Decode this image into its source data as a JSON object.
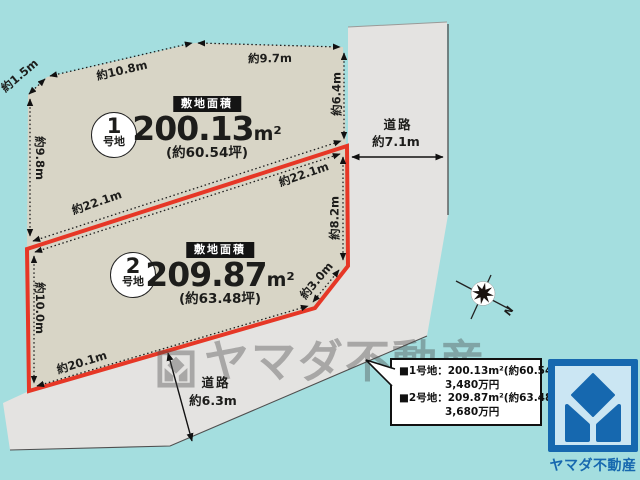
{
  "colors": {
    "background_teal": "#a4dedf",
    "plot_fill": "#d8d5c6",
    "road_fill": "#e4e3e1",
    "boundary_red": "#e63726",
    "brand_blue": "#1668af"
  },
  "plots": [
    {
      "circle_number": "1",
      "circle_suffix": "号地",
      "badge": "敷地面積",
      "area_value": "200.13",
      "area_unit": "m²",
      "tsubo": "(約60.54坪)"
    },
    {
      "circle_number": "2",
      "circle_suffix": "号地",
      "badge": "敷地面積",
      "area_value": "209.87",
      "area_unit": "m²",
      "tsubo": "(約63.48坪)"
    }
  ],
  "dims": {
    "nw_bevel": "約1.5m",
    "top_a": "約10.8m",
    "top_b": "約9.7m",
    "left_upper": "約9.8m",
    "right_upper": "約6.4m",
    "mid_plot1": "約22.1m",
    "mid_plot2": "約22.1m",
    "right_lower": "約8.2m",
    "left_lower": "約10.0m",
    "se_bevel": "約3.0m",
    "bottom": "約20.1m"
  },
  "roads": {
    "right": {
      "label": "道路",
      "width": "約7.1m"
    },
    "bottom": {
      "label": "道路",
      "width": "約6.3m"
    }
  },
  "compass": {
    "north_label": "N"
  },
  "info_box": {
    "line1": "■1号地：200.13m²(約60.54坪)",
    "line1_price": "3,480万円",
    "line2": "■2号地：209.87m²(約63.48坪)",
    "line2_price": "3,680万円"
  },
  "watermark": {
    "text": "ヤマダ不動産"
  },
  "brand": {
    "logo_text": "ヤマダ不動産"
  }
}
